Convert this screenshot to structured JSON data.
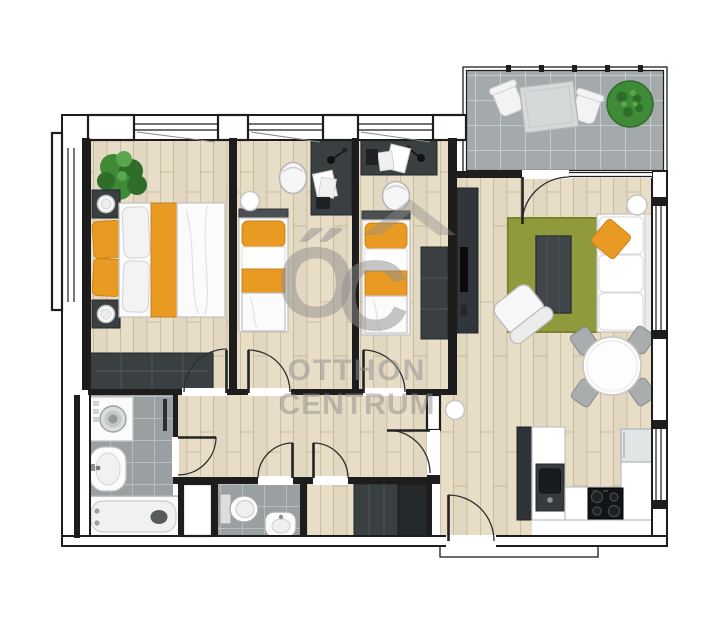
{
  "watermark": {
    "logo_o": "Ő",
    "logo_c": "C",
    "line1": "OTTHON",
    "line2": "CENTRUM"
  },
  "palette": {
    "wall": "#1d1d1d",
    "wood": "#e8ddc7",
    "woodLine": "#97815f",
    "tileBath": "#9aa0a2",
    "tileGrout": "#c3c8c9",
    "tileBalc": "#a4a9ab",
    "balcGrout": "#ced2d3",
    "darkFurn": "#3a3f42",
    "darkerFurn": "#25292c",
    "orange": "#e89a22",
    "orangeDeep": "#c97f10",
    "rug": "#8e9a3c",
    "rugEdge": "#79852d",
    "plant": "#3f8a37",
    "plantDark": "#2e6e29",
    "fridge": "#e1e5e6",
    "watermark": "#8f8f8f"
  }
}
